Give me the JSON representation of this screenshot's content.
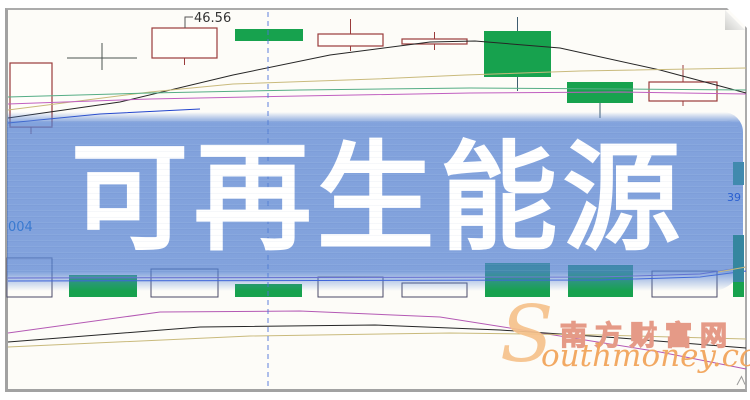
{
  "banner": {
    "title": "可再生能源",
    "bg_color": "#5280d2",
    "text_color": "#ffffff"
  },
  "axis_labels": {
    "left_partial": "004",
    "right_partial": "39"
  },
  "watermark": {
    "initial": "S",
    "latin": "outhmoney.com",
    "cjk": "南方财富网",
    "orange": "#f2a55c",
    "salmon": "#e59a87"
  },
  "colors": {
    "paper": "#fdfcf8",
    "up_outline": "#9a3b3b",
    "down_fill": "#17a24e",
    "volume_outline": "#4a4a68",
    "crosshair": "#4f74d8",
    "annotation_text": "#333333"
  },
  "chart_data": {
    "type": "candlestick",
    "note": "pixel-space coordinates; price axis hidden by banner overlay",
    "canvas": {
      "width": 750,
      "height": 400
    },
    "crosshair_x": 268,
    "annotation": {
      "text": "46.56",
      "x": 194,
      "y": 22,
      "elbow": [
        [
          185,
          28
        ],
        [
          185,
          17
        ],
        [
          193,
          17
        ]
      ]
    },
    "price_pane": {
      "candles": [
        {
          "x": 10,
          "w": 42,
          "top": 63,
          "bottom": 127,
          "kind": "hollow",
          "wick_low": 134
        },
        {
          "x": 152,
          "w": 65,
          "top": 28,
          "bottom": 58,
          "kind": "hollow",
          "wick_low": 65
        },
        {
          "x": 235,
          "w": 68,
          "top": 29,
          "bottom": 41,
          "kind": "green"
        },
        {
          "x": 318,
          "w": 65,
          "top": 34,
          "bottom": 46,
          "kind": "hollow",
          "wick_high": 19,
          "wick_low": 51
        },
        {
          "x": 402,
          "w": 65,
          "top": 39,
          "bottom": 44,
          "kind": "hollow",
          "wick_high": 32,
          "wick_low": 50
        },
        {
          "x": 484,
          "w": 67,
          "top": 31,
          "bottom": 77,
          "kind": "green",
          "wick_high": 17,
          "wick_low": 91
        },
        {
          "x": 567,
          "w": 66,
          "top": 82,
          "bottom": 103,
          "kind": "green",
          "wick_low": 118
        },
        {
          "x": 649,
          "w": 68,
          "top": 82,
          "bottom": 101,
          "kind": "hollow",
          "wick_high": 65,
          "wick_low": 106
        }
      ],
      "doji": {
        "x1": 67,
        "x2": 137,
        "y": 58,
        "cx": 102,
        "y1": 43,
        "y2": 70,
        "color": "#4a5350"
      },
      "ma_lines": [
        {
          "name": "black",
          "color": "#262626",
          "points": [
            [
              8,
              118
            ],
            [
              120,
              102
            ],
            [
              233,
              75
            ],
            [
              330,
              55
            ],
            [
              430,
              42
            ],
            [
              475,
              41
            ],
            [
              560,
              48
            ],
            [
              660,
              70
            ],
            [
              746,
              93
            ]
          ]
        },
        {
          "name": "khaki",
          "color": "#c9ba7c",
          "points": [
            [
              8,
              110
            ],
            [
              150,
              92
            ],
            [
              233,
              84
            ],
            [
              375,
              79
            ],
            [
              465,
              75
            ],
            [
              580,
              71
            ],
            [
              746,
              68
            ]
          ]
        },
        {
          "name": "teal",
          "color": "#55ad85",
          "points": [
            [
              8,
              97
            ],
            [
              150,
              93
            ],
            [
              300,
              90
            ],
            [
              470,
              88
            ],
            [
              620,
              89
            ],
            [
              746,
              90
            ]
          ]
        },
        {
          "name": "magenta",
          "color": "#c05fc0",
          "points": [
            [
              8,
              104
            ],
            [
              150,
              99
            ],
            [
              300,
              96
            ],
            [
              470,
              93
            ],
            [
              620,
              92
            ],
            [
              746,
              94
            ]
          ]
        },
        {
          "name": "blue",
          "color": "#2244cc",
          "points": [
            [
              8,
              123
            ],
            [
              100,
              114
            ],
            [
              200,
              109
            ]
          ]
        }
      ]
    },
    "volume_pane": {
      "baseline": 297,
      "bars": [
        {
          "x": 7,
          "w": 45,
          "top": 258,
          "kind": "hollow"
        },
        {
          "x": 69,
          "w": 68,
          "top": 275,
          "kind": "green"
        },
        {
          "x": 151,
          "w": 67,
          "top": 269,
          "kind": "hollow"
        },
        {
          "x": 235,
          "w": 67,
          "top": 284,
          "kind": "green"
        },
        {
          "x": 318,
          "w": 65,
          "top": 277,
          "kind": "hollow"
        },
        {
          "x": 402,
          "w": 65,
          "top": 283,
          "kind": "hollow"
        },
        {
          "x": 485,
          "w": 65,
          "top": 263,
          "kind": "green"
        },
        {
          "x": 568,
          "w": 65,
          "top": 265,
          "kind": "green"
        },
        {
          "x": 652,
          "w": 65,
          "top": 271,
          "kind": "hollow"
        }
      ],
      "ma_lines": [
        {
          "name": "vol-purple",
          "color": "#7a5fd0",
          "points": [
            [
              8,
              278
            ],
            [
              600,
              277
            ],
            [
              700,
              274
            ],
            [
              746,
              267
            ]
          ]
        },
        {
          "name": "vol-blue",
          "color": "#3355dd",
          "points": [
            [
              8,
              281
            ],
            [
              600,
              280
            ],
            [
              700,
              277
            ],
            [
              746,
              271
            ]
          ]
        },
        {
          "name": "vol-magenta",
          "color": "#b459b4",
          "points": [
            [
              8,
              333
            ],
            [
              160,
              312
            ],
            [
              300,
              311
            ],
            [
              440,
              317
            ],
            [
              560,
              336
            ],
            [
              660,
              352
            ],
            [
              746,
              369
            ]
          ]
        },
        {
          "name": "vol-black",
          "color": "#262626",
          "points": [
            [
              8,
              342
            ],
            [
              200,
              327
            ],
            [
              375,
              325
            ],
            [
              500,
              330
            ],
            [
              620,
              338
            ],
            [
              746,
              348
            ]
          ]
        },
        {
          "name": "vol-khaki",
          "color": "#c9ba7c",
          "points": [
            [
              8,
              347
            ],
            [
              250,
              336
            ],
            [
              450,
              333
            ],
            [
              600,
              335
            ],
            [
              746,
              339
            ]
          ]
        }
      ]
    },
    "overlay": {
      "right_candle": {
        "x": 733,
        "y": 162,
        "w": 11,
        "h": 23,
        "color": "#418aae"
      },
      "right_bar_top": {
        "x": 733,
        "y": 235,
        "w": 11,
        "h": 47,
        "color": "#35869f"
      },
      "right_bar_bottom": {
        "x": 733,
        "y": 282,
        "w": 11,
        "h": 15,
        "color": "#17a24e"
      },
      "khaki_tick": [
        [
          718,
          272
        ],
        [
          746,
          267
        ]
      ],
      "curl_path": "M737,385 L741.5,376.5 L745,384.5"
    }
  }
}
